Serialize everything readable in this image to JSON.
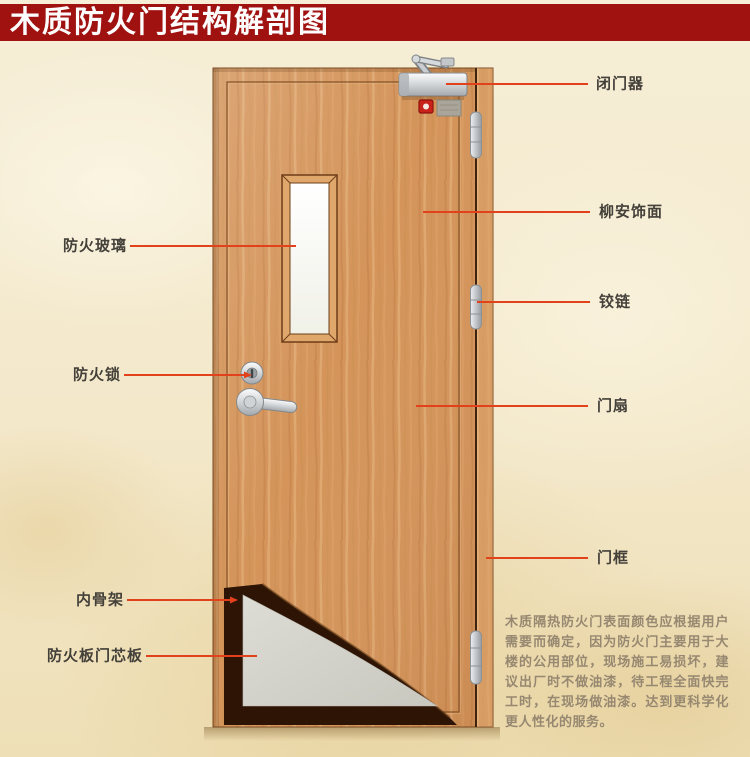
{
  "title": "木质防火门结构解剖图",
  "labels": {
    "left": [
      {
        "label": "防火玻璃"
      },
      {
        "label": "防火锁"
      },
      {
        "label": "内骨架"
      },
      {
        "label": "防火板门芯板"
      }
    ],
    "right": [
      {
        "label": "闭门器"
      },
      {
        "label": "柳安饰面"
      },
      {
        "label": "铰链"
      },
      {
        "label": "门扇"
      },
      {
        "label": "门框"
      }
    ]
  },
  "description": "木质隔热防火门表面颜色应根据用户需要而确定，因为防火门主要用于大楼的公用部位，现场施工易损坏，建议出厂时不做油漆，待工程全面快完工时，在现场做油漆。达到更科学化更人性化的服务。",
  "colors": {
    "title_bar": "#a01210",
    "leader_line": "#e2421b",
    "door_wood": "#d4945a",
    "door_core_board": "#d6d5ce",
    "inner_skeleton": "#2d1404",
    "glass": "#fbfbf3",
    "background": "#f3e8cb"
  }
}
